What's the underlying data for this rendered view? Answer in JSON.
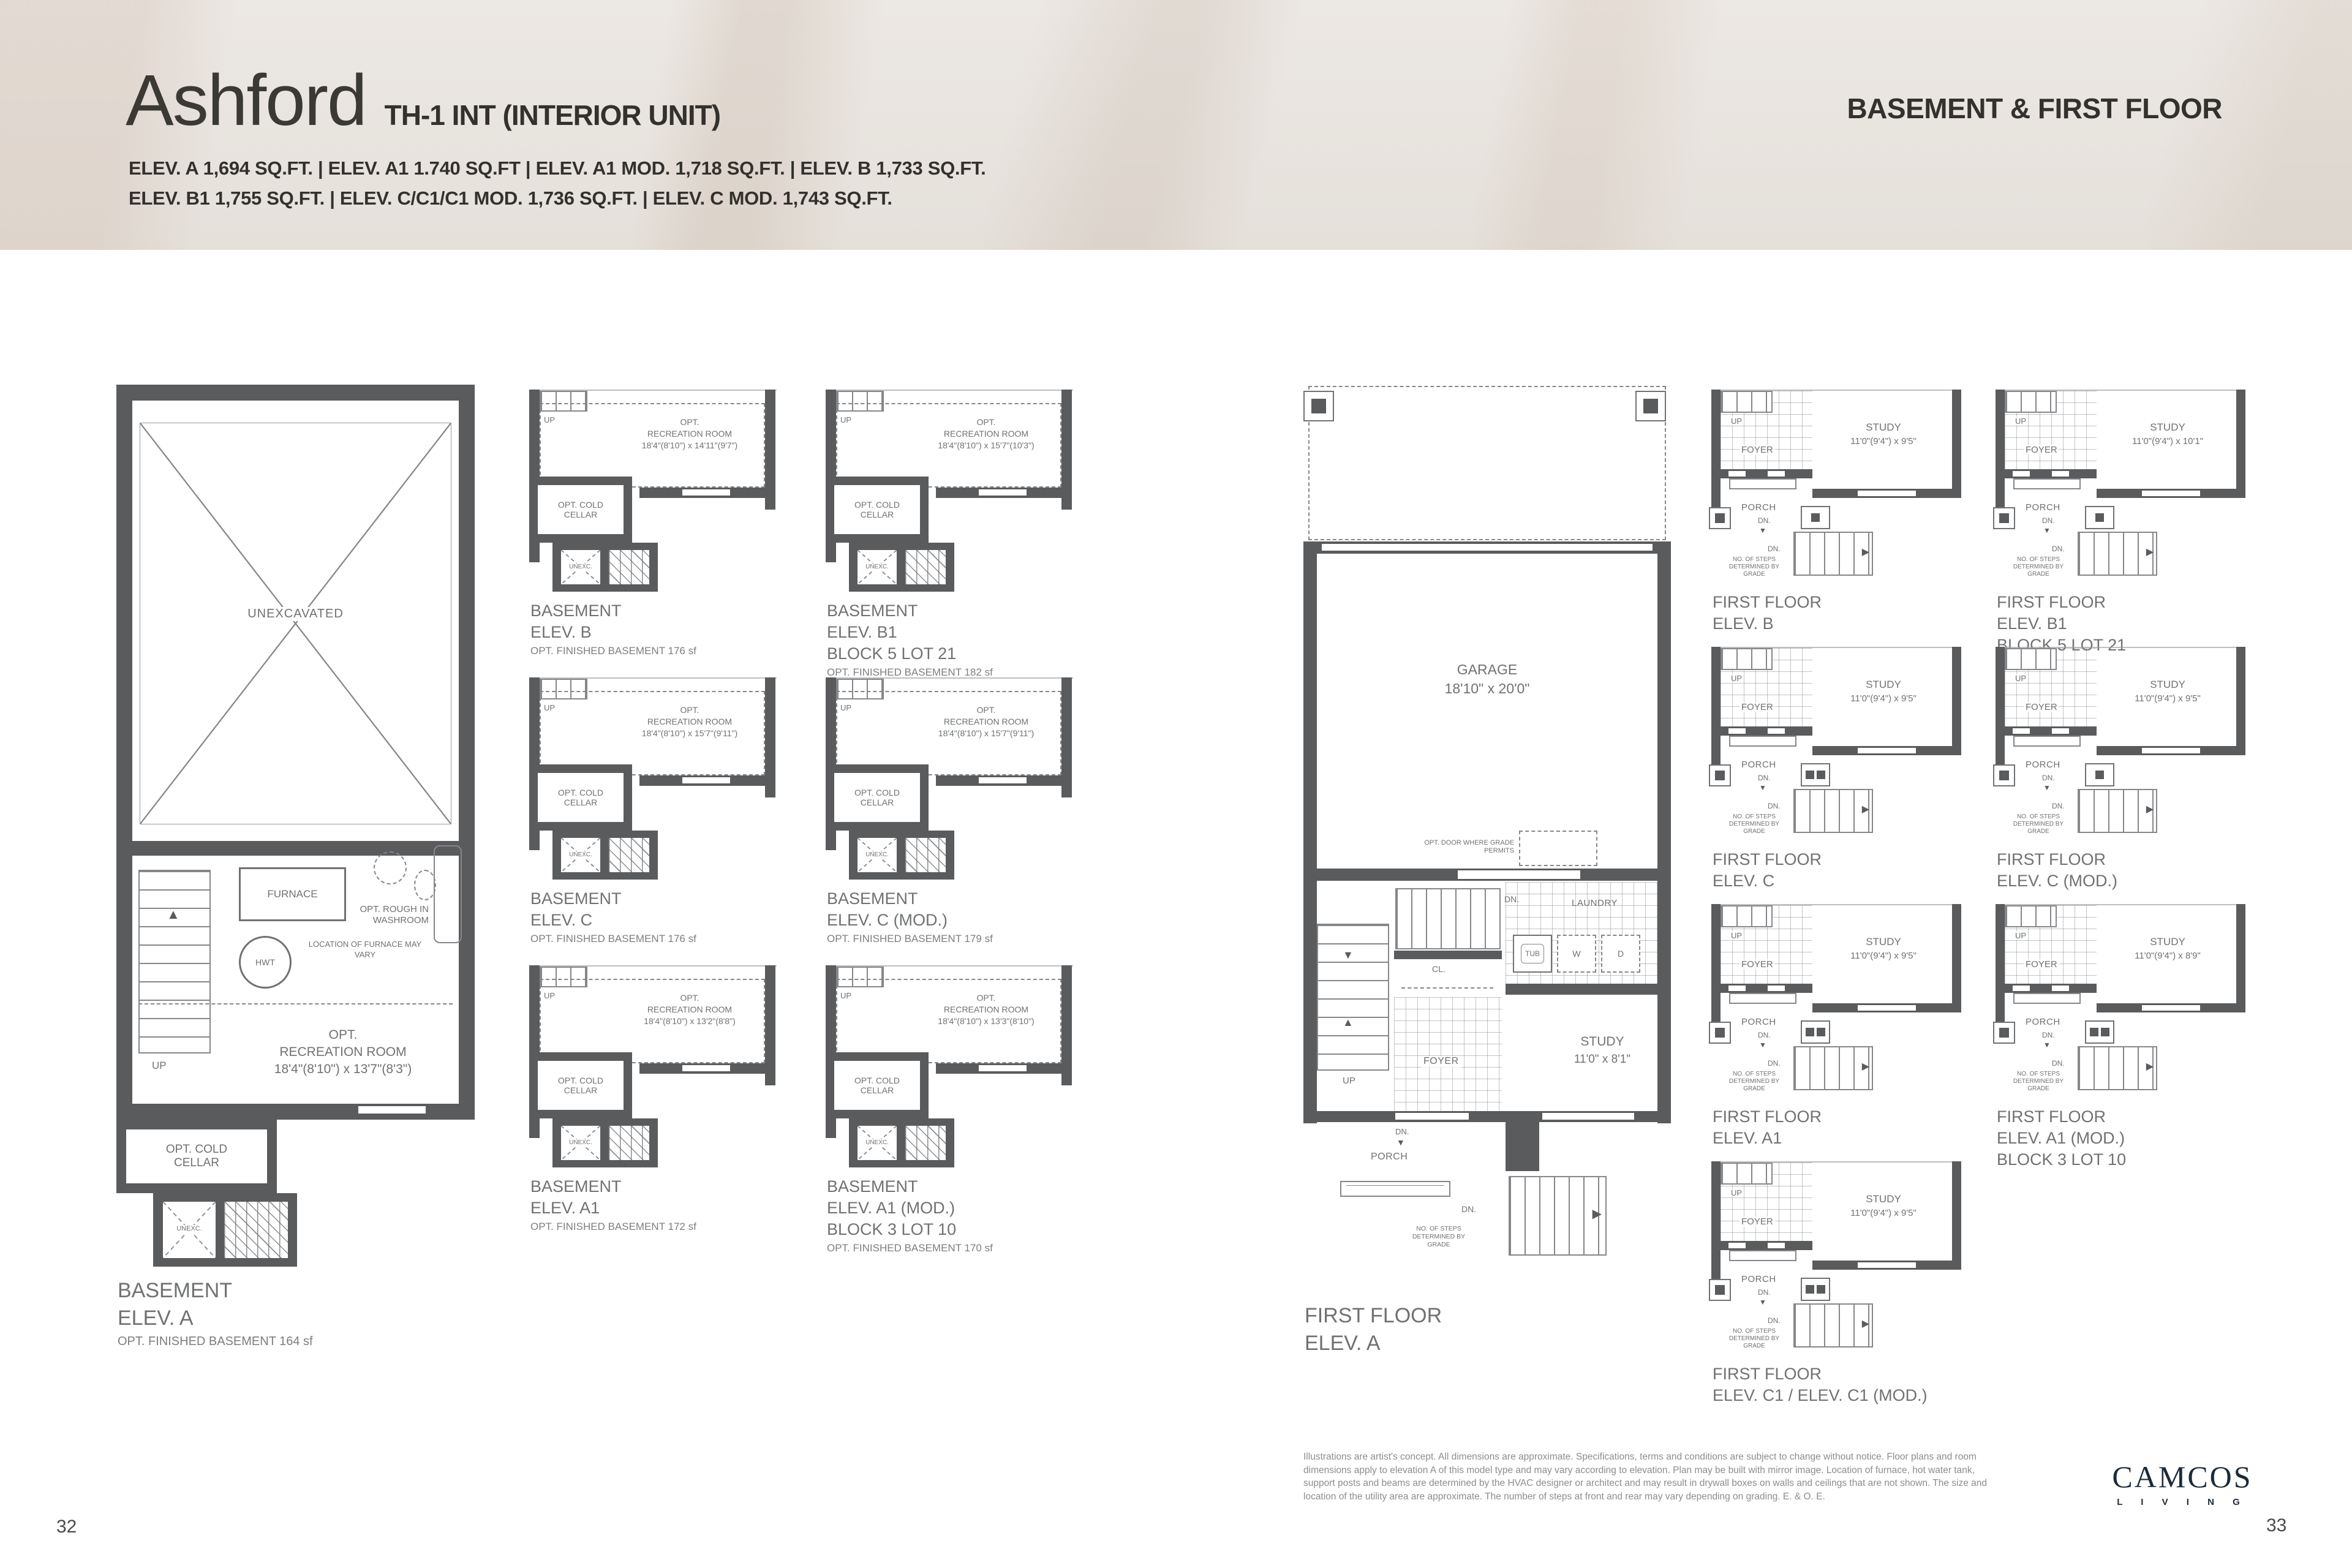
{
  "header": {
    "title": "Ashford",
    "subtitle": "TH-1 INT (INTERIOR UNIT)",
    "section": "BASEMENT & FIRST FLOOR",
    "specs_line1": "ELEV. A  1,694 SQ.FT. | ELEV. A1 1.740 SQ.FT | ELEV. A1 MOD. 1,718 SQ.FT. | ELEV. B  1,733 SQ.FT.",
    "specs_line2": "ELEV. B1  1,755 SQ.FT. |  ELEV. C/C1/C1 MOD.  1,736 SQ.FT. | ELEV. C MOD. 1,743 SQ.FT."
  },
  "labels": {
    "opt": "OPT.",
    "rec_room": "RECREATION ROOM",
    "cold_cellar": "OPT. COLD CELLAR",
    "unexc": "UNEXC.",
    "unexcavated": "UNEXCAVATED",
    "up": "UP",
    "dn": "DN.",
    "foyer": "FOYER",
    "porch": "PORCH",
    "study": "STUDY",
    "laundry": "LAUNDRY",
    "cl": "CL.",
    "tub": "TUB",
    "washer": "W",
    "dryer": "D",
    "garage": "GARAGE",
    "basement": "BASEMENT",
    "first_floor": "FIRST FLOOR",
    "furnace": "FURNACE",
    "hwt": "HWT",
    "furnace_note": "LOCATION OF FURNACE MAY VARY",
    "washroom_note": "OPT. ROUGH IN WASHROOM",
    "steps_note": "NO. OF STEPS DETERMINED BY GRADE",
    "opt_door_note": "OPT. DOOR WHERE GRADE PERMITS"
  },
  "basement_a": {
    "dims": "18'4\"(8'10\") x 13'7\"(8'3\")",
    "elev": "ELEV. A",
    "sf": "OPT. FINISHED BASEMENT 164 sf"
  },
  "first_a": {
    "garage_dims": "18'10\" x 20'0\"",
    "study_dims": "11'0\" x 8'1\"",
    "elev": "ELEV. A"
  },
  "basement_plans": [
    {
      "dims": "18'4\"(8'10\") x 14'11\"(9'7\")",
      "elev": "ELEV. B",
      "block": "",
      "sf": "OPT. FINISHED BASEMENT 176 sf"
    },
    {
      "dims": "18'4\"(8'10\") x 15'7\"(10'3\")",
      "elev": "ELEV. B1",
      "block": "BLOCK 5 LOT 21",
      "sf": "OPT. FINISHED BASEMENT 182 sf"
    },
    {
      "dims": "18'4\"(8'10\") x 15'7\"(9'11\")",
      "elev": "ELEV. C",
      "block": "",
      "sf": "OPT. FINISHED BASEMENT 176 sf"
    },
    {
      "dims": "18'4\"(8'10\") x 15'7\"(9'11\")",
      "elev": "ELEV. C (MOD.)",
      "block": "",
      "sf": "OPT. FINISHED BASEMENT 179 sf"
    },
    {
      "dims": "18'4\"(8'10\") x 13'2\"(8'8\")",
      "elev": "ELEV. A1",
      "block": "",
      "sf": "OPT. FINISHED BASEMENT 172 sf"
    },
    {
      "dims": "18'4\"(8'10\") x 13'3\"(8'10\")",
      "elev": "ELEV. A1 (MOD.)",
      "block": "BLOCK 3 LOT 10",
      "sf": "OPT. FINISHED BASEMENT 170 sf"
    }
  ],
  "first_plans": [
    {
      "dims": "11'0\"(9'4\") x 9'5\"",
      "elev": "ELEV. B",
      "block": ""
    },
    {
      "dims": "11'0\"(9'4\") x 10'1\"",
      "elev": "ELEV. B1",
      "block": "BLOCK 5 LOT 21"
    },
    {
      "dims": "11'0\"(9'4\") x 9'5\"",
      "elev": "ELEV. C",
      "block": ""
    },
    {
      "dims": "11'0\"(9'4\") x 9'5\"",
      "elev": "ELEV. C (MOD.)",
      "block": ""
    },
    {
      "dims": "11'0\"(9'4\") x 9'5\"",
      "elev": "ELEV. A1",
      "block": ""
    },
    {
      "dims": "11'0\"(9'4\") x 8'9\"",
      "elev": "ELEV. A1 (MOD.)",
      "block": "BLOCK 3 LOT 10"
    },
    {
      "dims": "11'0\"(9'4\") x 9'5\"",
      "elev": "ELEV. C1 / ELEV. C1 (MOD.)",
      "block": ""
    }
  ],
  "footer": {
    "disclaimer": "Illustrations are artist's concept. All dimensions are approximate. Specifications, terms and conditions are subject to change without notice. Floor plans and room dimensions apply to elevation A of this model type and may vary according to elevation. Plan may be built with mirror image. Location of furnace, hot water tank, support posts and beams are determined by the HVAC designer or architect and may result in drywall boxes on walls and ceilings that are not shown. The size and location of the utility area are approximate. The number of steps at front and rear may vary depending on grading. E. & O. E.",
    "logo_line1": "CAMCOS",
    "logo_line2": "L I V I N G",
    "page_left": "32",
    "page_right": "33"
  },
  "colors": {
    "wall": "#595b5d",
    "line": "#85878a",
    "text": "#6f7173",
    "title": "#3a3933",
    "logo": "#1d2a38"
  }
}
